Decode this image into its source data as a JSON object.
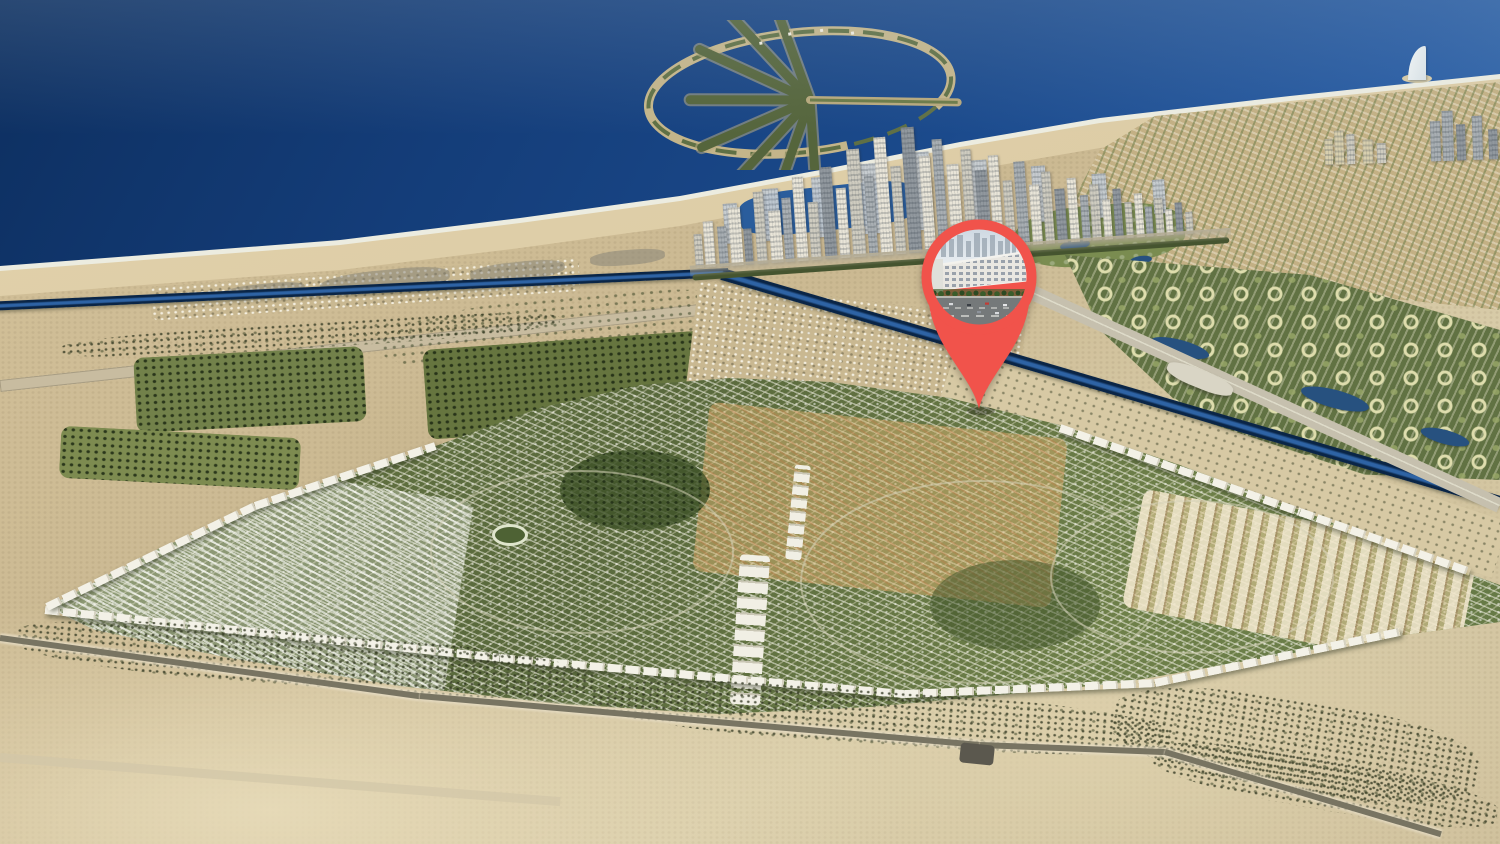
{
  "scene": {
    "type": "aerial-masterplan-render",
    "marker": {
      "name": "location-pin",
      "color": "#F1534B",
      "thumbnail": "white mid-rise apartment block beside a tree-lined multi-lane road"
    },
    "palette": {
      "sea_deep": "#0D2F60",
      "sea_light": "#4A7FBA",
      "beach": "#DCCAA2",
      "desert": "#D5C49E",
      "community_green": "#5F7342",
      "canal": "#0C2B52",
      "white_buildings": "#F3F1E7",
      "tower_gray": "#A9AFB3",
      "pin_red": "#F1534B"
    },
    "landmarks": [
      "palm-island",
      "marina-skyline",
      "sail-tower",
      "coastline",
      "canal",
      "master-community",
      "desert-foreground"
    ]
  }
}
